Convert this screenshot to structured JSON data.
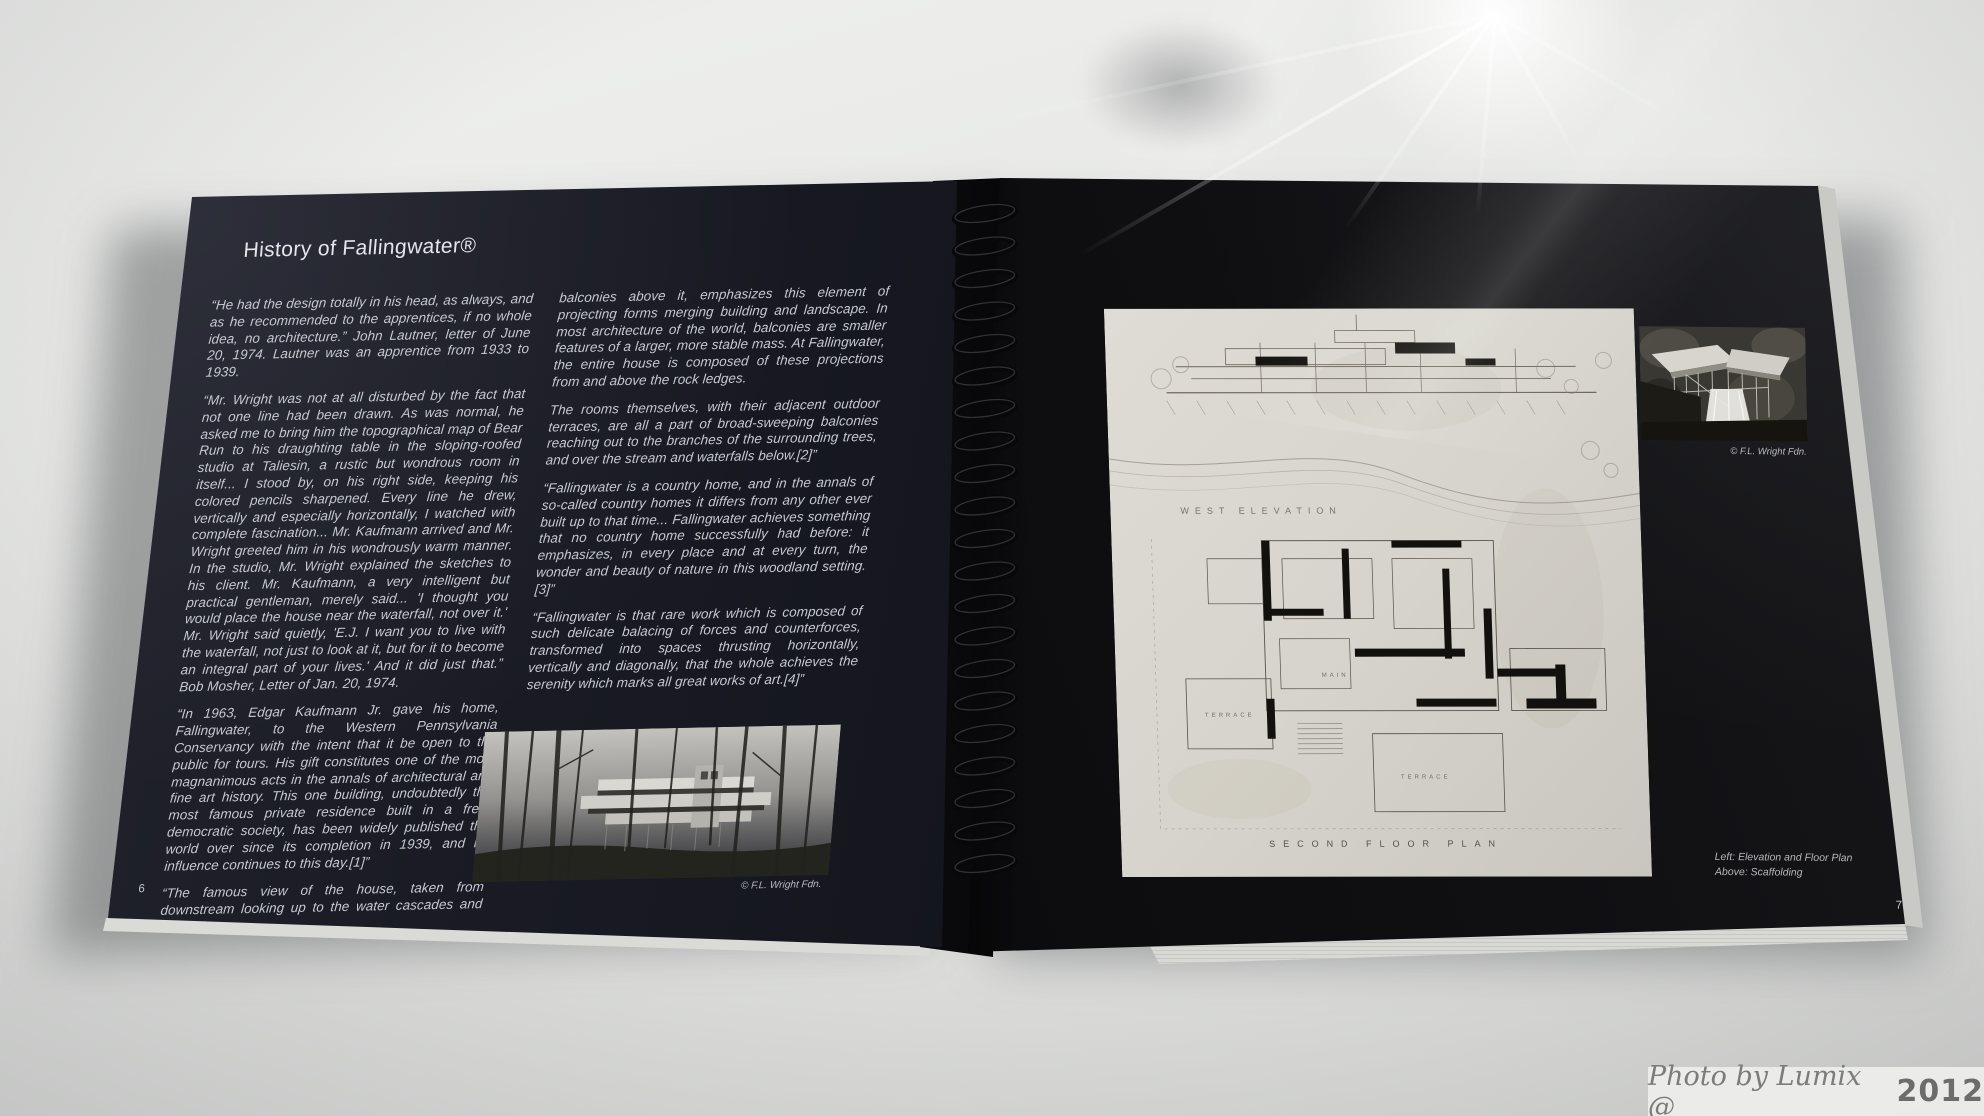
{
  "watermark": {
    "text": "Photo by Lumix @",
    "year": "2012"
  },
  "left_page": {
    "page_number": "6",
    "title": "History of Fallingwater®",
    "column1": [
      "“He had the design totally in his head, as always, and as he recommended to the apprentices, if no whole idea, no architecture.” John Lautner, letter of June 20, 1974. Lautner was an apprentice from 1933 to 1939.",
      "“Mr. Wright was not at all disturbed by the fact that not one line had been drawn. As was normal, he asked me to bring him the topographical map of Bear Run to his draughting table in the sloping-roofed studio at Taliesin, a rustic but wondrous room in itself... I stood by, on his right side, keeping his colored pencils sharpened. Every line he drew, vertically and especially horizontally, I watched with complete fascination... Mr. Kaufmann arrived and Mr. Wright greeted him in his wondrously warm manner. In the studio, Mr. Wright explained the sketches to his client. Mr. Kaufmann, a very intelligent but practical gentleman, merely said... 'I thought you would place the house near the waterfall, not over it.' Mr. Wright said quietly, 'E.J. I want you to live with the waterfall, not just to look at it, but for it to become an integral part of your lives.' And it did just that.” Bob Mosher, Letter of Jan. 20, 1974.",
      "“In 1963, Edgar Kaufmann Jr. gave his home, Fallingwater, to the Western Pennsylvania Conservancy with the intent that it be open to the public for tours. His gift constitutes one of the most magnanimous acts in the annals of architectural and fine art history. This one building, undoubtedly the most famous private residence built in a free, democratic society, has been widely published the world over since its completion in 1939, and its influence continues to this day.[1]”",
      "“The famous view of the house, taken from downstream looking up to the water cascades and under the"
    ],
    "column2": [
      "balconies above it, emphasizes this element of projecting forms merging building and landscape. In most architecture of the world, balconies are smaller features of a larger, more stable mass. At Fallingwater, the entire house is composed of these projections from and above the rock ledges.",
      "The rooms themselves, with their adjacent outdoor terraces, are all a part of broad-sweeping balconies reaching out to the branches of the surrounding trees, and over the stream and waterfalls below.[2]”",
      "“Fallingwater is a country home, and in the annals of so-called country homes it differs from any other ever built up to that time... Fallingwater achieves something that no country home successfully had before: it emphasizes, in every place and at every turn, the wonder and beauty of nature in this woodland setting.[3]”",
      "“Fallingwater is that rare work which is composed of such delicate balacing of forces and counterforces, transformed into spaces thrusting horizontally, vertically and diagonally, that the whole achieves the serenity which marks all great works of art.[4]”"
    ],
    "photo_credit": "© F.L. Wright Fdn."
  },
  "right_page": {
    "page_number": "7",
    "drawing_labels": {
      "elevation": "WEST ELEVATION",
      "floor_plan": "SECOND FLOOR PLAN",
      "room_a": "TERRACE",
      "room_b": "MAIN",
      "room_c": "TERRACE"
    },
    "photo_credit": "© F.L. Wright Fdn.",
    "caption_line1": "Left: Elevation and Floor Plan",
    "caption_line2": "Above: Scaffolding"
  },
  "colors": {
    "page_dark": "#1a1b24",
    "page_darker": "#0e0e11",
    "text_light": "#c9cbd3",
    "plan_paper": "#d8d6cf",
    "surface": "#e4e5e3"
  }
}
